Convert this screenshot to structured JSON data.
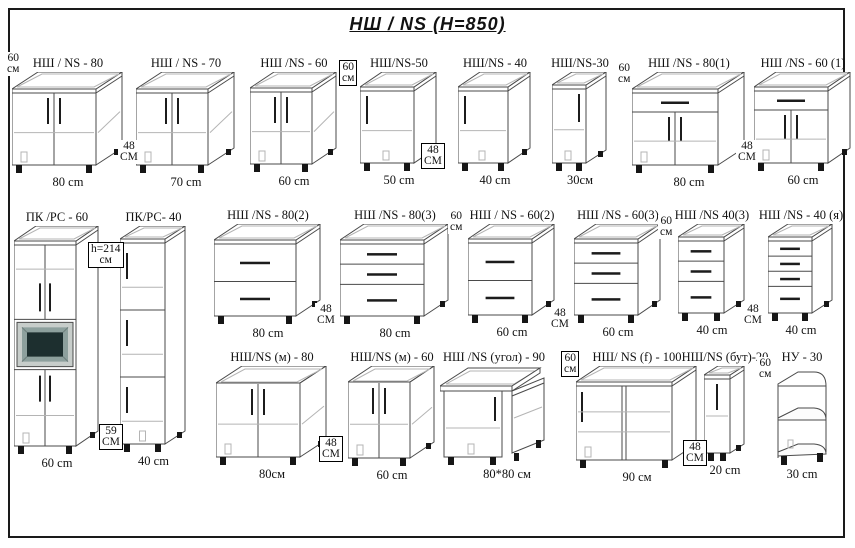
{
  "title": "НШ / NS  (H=850)",
  "colors": {
    "line": "#4a4a4a",
    "light": "#b4b4b4",
    "handle": "#1c1c1c",
    "leg": "#161616",
    "oven_frame": "#c7cdca",
    "oven_bezel": "#8da09d",
    "oven_screen": "#1d2f2f",
    "border": "#1a1a1a"
  },
  "cabinets": [
    {
      "id": "ns-80",
      "label": "НШ / NS - 80",
      "dim": "80 cm",
      "type": "doors2",
      "x": 12,
      "y": 56,
      "w": 84,
      "h": 76,
      "d": 26
    },
    {
      "id": "ns-70",
      "label": "НШ / NS - 70",
      "dim": "70 cm",
      "type": "doors2",
      "x": 136,
      "y": 56,
      "w": 72,
      "h": 76,
      "d": 26
    },
    {
      "id": "ns-60",
      "label": "НШ /NS - 60",
      "dim": "60 cm",
      "type": "doors2",
      "x": 250,
      "y": 56,
      "w": 62,
      "h": 76,
      "d": 24
    },
    {
      "id": "ns-50",
      "label": "НШ/NS-50",
      "dim": "50 cm",
      "type": "door1",
      "x": 360,
      "y": 56,
      "w": 54,
      "h": 76,
      "d": 22
    },
    {
      "id": "ns-40",
      "label": "НШ/NS - 40",
      "dim": "40 cm",
      "type": "door1",
      "x": 458,
      "y": 56,
      "w": 50,
      "h": 76,
      "d": 22
    },
    {
      "id": "ns-30",
      "label": "НШ/NS-30",
      "dim": "30см",
      "type": "door1r",
      "x": 552,
      "y": 56,
      "w": 34,
      "h": 78,
      "d": 20
    },
    {
      "id": "ns-80-1",
      "label": "НШ /NS - 80(1)",
      "dim": "80 cm",
      "type": "drawerdoors",
      "x": 632,
      "y": 56,
      "w": 86,
      "h": 76,
      "d": 26
    },
    {
      "id": "ns-60-1",
      "label": "НШ /NS - 60 (1)",
      "dim": "60 cm",
      "type": "drawerdoors",
      "x": 754,
      "y": 56,
      "w": 74,
      "h": 76,
      "d": 22
    },
    {
      "id": "pk-rc-60",
      "label": "ПК /РС - 60",
      "dim": "60 cm",
      "type": "tallOven",
      "x": 14,
      "y": 210,
      "w": 62,
      "h": 205,
      "d": 22
    },
    {
      "id": "pk-rc-40",
      "label": "ПК/РС- 40",
      "dim": "40 cm",
      "type": "tall3",
      "x": 120,
      "y": 210,
      "w": 45,
      "h": 205,
      "d": 20
    },
    {
      "id": "ns-80-2",
      "label": "НШ /NS - 80(2)",
      "dim": "80 cm",
      "type": "drawers2",
      "x": 214,
      "y": 208,
      "w": 82,
      "h": 76,
      "d": 24
    },
    {
      "id": "ns-80-3",
      "label": "НШ /NS - 80(3)",
      "dim": "80 cm",
      "type": "drawers3",
      "x": 340,
      "y": 208,
      "w": 84,
      "h": 76,
      "d": 24
    },
    {
      "id": "ns-60-2",
      "label": "НШ / NS - 60(2)",
      "dim": "60 cm",
      "type": "drawers2",
      "x": 468,
      "y": 208,
      "w": 64,
      "h": 76,
      "d": 22
    },
    {
      "id": "ns-60-3",
      "label": "НШ /NS - 60(3)",
      "dim": "60 cm",
      "type": "drawers3",
      "x": 574,
      "y": 208,
      "w": 64,
      "h": 76,
      "d": 22
    },
    {
      "id": "ns-40-3",
      "label": "НШ /NS 40(3)",
      "dim": "40 cm",
      "type": "drawers3",
      "x": 678,
      "y": 208,
      "w": 46,
      "h": 76,
      "d": 20
    },
    {
      "id": "ns-40-ya",
      "label": "НШ /NS - 40 (я)",
      "dim": "40 cm",
      "type": "drawers4",
      "x": 768,
      "y": 208,
      "w": 44,
      "h": 76,
      "d": 20
    },
    {
      "id": "ns-m-80",
      "label": "НШ/NS (м) - 80",
      "dim": "80см",
      "type": "sink2",
      "x": 216,
      "y": 350,
      "w": 84,
      "h": 74,
      "d": 26
    },
    {
      "id": "ns-m-60",
      "label": "НШ/NS (м) - 60",
      "dim": "60 cm",
      "type": "sink2",
      "x": 348,
      "y": 350,
      "w": 62,
      "h": 76,
      "d": 24
    },
    {
      "id": "ns-ugol-90",
      "label": "НШ /NS (угол) - 90",
      "dim": "80*80 см",
      "type": "corner",
      "x": 440,
      "y": 350,
      "w": 112,
      "h": 78,
      "d": 28,
      "dimDx": 26
    },
    {
      "id": "ns-f-100",
      "label": "НШ/ NS (f) - 100",
      "dim": "90 см",
      "type": "wide2",
      "x": 576,
      "y": 350,
      "w": 96,
      "h": 78,
      "d": 24
    },
    {
      "id": "ns-but-20",
      "label": "НШ/NS (бут)-20",
      "dim": "20 cm",
      "type": "but",
      "x": 704,
      "y": 350,
      "w": 26,
      "h": 78,
      "d": 14
    },
    {
      "id": "nu-30",
      "label": "НУ - 30",
      "dim": "30 cm",
      "type": "nu",
      "x": 772,
      "y": 350,
      "w": 52,
      "h": 82,
      "d": 16
    }
  ],
  "annotations": [
    {
      "lines": [
        "60",
        "см"
      ],
      "x": 5,
      "y": 52,
      "boxed": false
    },
    {
      "lines": [
        "48",
        "СМ"
      ],
      "x": 118,
      "y": 140,
      "boxed": false
    },
    {
      "lines": [
        "60",
        "см"
      ],
      "x": 339,
      "y": 60,
      "boxed": true
    },
    {
      "lines": [
        "48",
        "СМ"
      ],
      "x": 421,
      "y": 143,
      "boxed": true
    },
    {
      "lines": [
        "60",
        "см"
      ],
      "x": 616,
      "y": 62,
      "boxed": false
    },
    {
      "lines": [
        "48",
        "СМ"
      ],
      "x": 736,
      "y": 140,
      "boxed": false
    },
    {
      "lines": [
        "h=214",
        "см"
      ],
      "x": 88,
      "y": 242,
      "boxed": true
    },
    {
      "lines": [
        "59",
        "СМ"
      ],
      "x": 99,
      "y": 424,
      "boxed": true
    },
    {
      "lines": [
        "48",
        "СМ"
      ],
      "x": 315,
      "y": 303,
      "boxed": false
    },
    {
      "lines": [
        "60",
        "см"
      ],
      "x": 448,
      "y": 210,
      "boxed": false
    },
    {
      "lines": [
        "48",
        "СМ"
      ],
      "x": 549,
      "y": 307,
      "boxed": false
    },
    {
      "lines": [
        "60",
        "см"
      ],
      "x": 658,
      "y": 215,
      "boxed": false
    },
    {
      "lines": [
        "48",
        "СМ"
      ],
      "x": 742,
      "y": 303,
      "boxed": false
    },
    {
      "lines": [
        "48",
        "СМ"
      ],
      "x": 319,
      "y": 436,
      "boxed": true
    },
    {
      "lines": [
        "60",
        "см"
      ],
      "x": 561,
      "y": 351,
      "boxed": true
    },
    {
      "lines": [
        "48",
        "СМ"
      ],
      "x": 683,
      "y": 440,
      "boxed": true
    },
    {
      "lines": [
        "60",
        "см"
      ],
      "x": 757,
      "y": 357,
      "boxed": false
    }
  ]
}
